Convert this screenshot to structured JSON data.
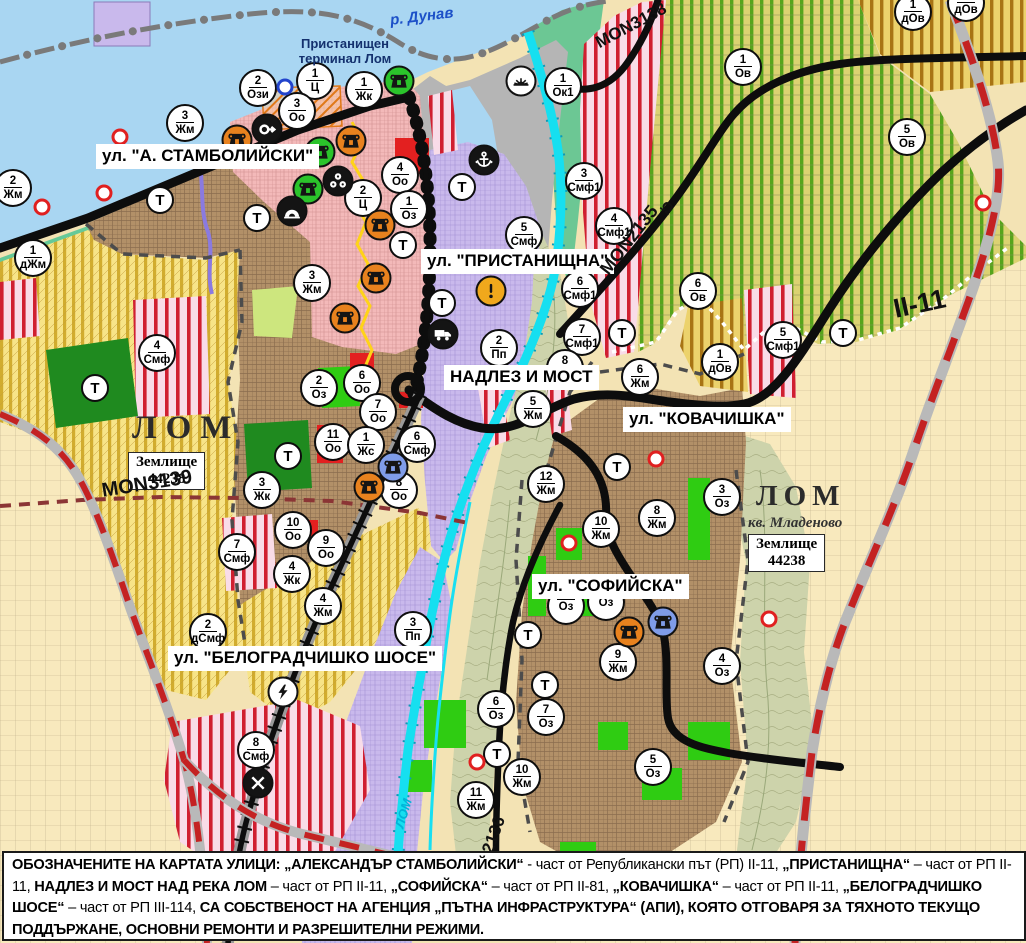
{
  "water": {
    "danube_label": "р. Дунав",
    "river_label": "ЛОМ"
  },
  "places": {
    "terminal_line1": "Пристанищен",
    "terminal_line2": "терминал Лом",
    "city1": "ЛОМ",
    "city2": "ЛОМ",
    "quarter": "кв. Младеново",
    "landplot_line1": "Землище",
    "landplot_line2": "44238"
  },
  "street_labels": [
    {
      "text": "ул. \"А. СТАМБОЛИЙСКИ\"",
      "x": 96,
      "y": 144
    },
    {
      "text": "ул. \"ПРИСТАНИЩНА\"",
      "x": 421,
      "y": 249
    },
    {
      "text": "НАДЛЕЗ И МОСТ",
      "x": 444,
      "y": 365
    },
    {
      "text": "ул. \"КОВАЧИШКА\"",
      "x": 623,
      "y": 407
    },
    {
      "text": "ул. \"СОФИЙСКА\"",
      "x": 532,
      "y": 574
    },
    {
      "text": "ул. \"БЕЛОГРАДЧИШКО ШОСЕ\"",
      "x": 168,
      "y": 646
    }
  ],
  "road_labels": [
    {
      "text": "MON3139",
      "x": 102,
      "y": 480,
      "rot": -9,
      "size": 20
    },
    {
      "text": "MON3138",
      "x": 597,
      "y": 34,
      "rot": -28,
      "size": 17
    },
    {
      "text": "MON2135",
      "x": 604,
      "y": 262,
      "rot": -52,
      "size": 18
    },
    {
      "text": "Ω",
      "x": 662,
      "y": 196,
      "rot": 38,
      "size": 15
    },
    {
      "text": "II-11",
      "x": 894,
      "y": 294,
      "rot": -12,
      "size": 27
    },
    {
      "text": "MON2136",
      "x": 474,
      "y": 880,
      "rot": -70,
      "size": 17
    }
  ],
  "zone_markers": [
    {
      "x": 13,
      "y": 188,
      "n": "2",
      "z": "Жм"
    },
    {
      "x": 185,
      "y": 123,
      "n": "3",
      "z": "Жм"
    },
    {
      "x": 258,
      "y": 88,
      "n": "2",
      "z": "Ози"
    },
    {
      "x": 315,
      "y": 81,
      "n": "1",
      "z": "Ц"
    },
    {
      "x": 297,
      "y": 111,
      "n": "3",
      "z": "Оо"
    },
    {
      "x": 364,
      "y": 90,
      "n": "1",
      "z": "Жк"
    },
    {
      "x": 400,
      "y": 175,
      "n": "4",
      "z": "Оо"
    },
    {
      "x": 363,
      "y": 198,
      "n": "2",
      "z": "Ц"
    },
    {
      "x": 409,
      "y": 209,
      "n": "1",
      "z": "Оз"
    },
    {
      "x": 563,
      "y": 86,
      "n": "1",
      "z": "Ок1"
    },
    {
      "x": 584,
      "y": 181,
      "n": "3",
      "z": "Смф1"
    },
    {
      "x": 524,
      "y": 235,
      "n": "5",
      "z": "Смф"
    },
    {
      "x": 614,
      "y": 226,
      "n": "4",
      "z": "Смф1"
    },
    {
      "x": 580,
      "y": 289,
      "n": "6",
      "z": "Смф1"
    },
    {
      "x": 582,
      "y": 337,
      "n": "7",
      "z": "Смф1"
    },
    {
      "x": 565,
      "y": 368,
      "n": "8",
      "z": "Жм"
    },
    {
      "x": 499,
      "y": 348,
      "n": "2",
      "z": "Пп"
    },
    {
      "x": 533,
      "y": 409,
      "n": "5",
      "z": "Жм"
    },
    {
      "x": 546,
      "y": 484,
      "n": "12",
      "z": "Жм"
    },
    {
      "x": 640,
      "y": 377,
      "n": "6",
      "z": "Жм"
    },
    {
      "x": 698,
      "y": 291,
      "n": "6",
      "z": "Ов"
    },
    {
      "x": 720,
      "y": 362,
      "n": "1",
      "z": "дОв"
    },
    {
      "x": 783,
      "y": 340,
      "n": "5",
      "z": "Смф1"
    },
    {
      "x": 743,
      "y": 67,
      "n": "1",
      "z": "Ов"
    },
    {
      "x": 907,
      "y": 137,
      "n": "5",
      "z": "Ов"
    },
    {
      "x": 913,
      "y": 12,
      "n": "1",
      "z": "дОв"
    },
    {
      "x": 966,
      "y": 3,
      "n": "1",
      "z": "дОв"
    },
    {
      "x": 33,
      "y": 258,
      "n": "1",
      "z": "дЖм"
    },
    {
      "x": 157,
      "y": 353,
      "n": "4",
      "z": "Смф"
    },
    {
      "x": 312,
      "y": 283,
      "n": "3",
      "z": "Жм"
    },
    {
      "x": 319,
      "y": 388,
      "n": "2",
      "z": "Оз"
    },
    {
      "x": 362,
      "y": 383,
      "n": "6",
      "z": "Оо"
    },
    {
      "x": 378,
      "y": 412,
      "n": "7",
      "z": "Оо"
    },
    {
      "x": 333,
      "y": 442,
      "n": "11",
      "z": "Оо"
    },
    {
      "x": 366,
      "y": 445,
      "n": "1",
      "z": "Жс"
    },
    {
      "x": 417,
      "y": 444,
      "n": "6",
      "z": "Смф"
    },
    {
      "x": 399,
      "y": 490,
      "n": "8",
      "z": "Оо"
    },
    {
      "x": 262,
      "y": 490,
      "n": "3",
      "z": "Жк"
    },
    {
      "x": 293,
      "y": 530,
      "n": "10",
      "z": "Оо"
    },
    {
      "x": 326,
      "y": 548,
      "n": "9",
      "z": "Оо"
    },
    {
      "x": 292,
      "y": 574,
      "n": "4",
      "z": "Жк"
    },
    {
      "x": 323,
      "y": 606,
      "n": "4",
      "z": "Жм"
    },
    {
      "x": 237,
      "y": 552,
      "n": "7",
      "z": "Смф"
    },
    {
      "x": 208,
      "y": 632,
      "n": "2",
      "z": "дСмф"
    },
    {
      "x": 413,
      "y": 630,
      "n": "3",
      "z": "Пп"
    },
    {
      "x": 256,
      "y": 750,
      "n": "8",
      "z": "Смф"
    },
    {
      "x": 601,
      "y": 529,
      "n": "10",
      "z": "Жм"
    },
    {
      "x": 657,
      "y": 518,
      "n": "8",
      "z": "Жм"
    },
    {
      "x": 566,
      "y": 606,
      "n": "",
      "z": "Оз"
    },
    {
      "x": 606,
      "y": 602,
      "n": "",
      "z": "Оз"
    },
    {
      "x": 618,
      "y": 662,
      "n": "9",
      "z": "Жм"
    },
    {
      "x": 722,
      "y": 666,
      "n": "4",
      "z": "Оз"
    },
    {
      "x": 496,
      "y": 709,
      "n": "6",
      "z": "Оз"
    },
    {
      "x": 546,
      "y": 717,
      "n": "7",
      "z": "Оз"
    },
    {
      "x": 653,
      "y": 767,
      "n": "5",
      "z": "Оз"
    },
    {
      "x": 522,
      "y": 777,
      "n": "10",
      "z": "Жм"
    },
    {
      "x": 476,
      "y": 800,
      "n": "11",
      "z": "Жм"
    },
    {
      "x": 722,
      "y": 497,
      "n": "3",
      "z": "Оз"
    }
  ],
  "t_markers": [
    {
      "x": 160,
      "y": 200
    },
    {
      "x": 257,
      "y": 218
    },
    {
      "x": 403,
      "y": 245
    },
    {
      "x": 442,
      "y": 303
    },
    {
      "x": 462,
      "y": 187
    },
    {
      "x": 95,
      "y": 388
    },
    {
      "x": 288,
      "y": 456
    },
    {
      "x": 622,
      "y": 333
    },
    {
      "x": 843,
      "y": 333
    },
    {
      "x": 617,
      "y": 467
    },
    {
      "x": 528,
      "y": 635
    },
    {
      "x": 545,
      "y": 685
    },
    {
      "x": 497,
      "y": 754
    }
  ],
  "t_label": "Т",
  "icon_markers": [
    {
      "x": 237,
      "y": 140,
      "icon": "monument-capital-icon",
      "bg": "#e8821e"
    },
    {
      "x": 267,
      "y": 129,
      "icon": "key-route-icon",
      "bg": "#141414"
    },
    {
      "x": 320,
      "y": 152,
      "icon": "monument-capital-icon",
      "bg": "#2bc42b"
    },
    {
      "x": 351,
      "y": 141,
      "icon": "monument-capital-icon",
      "bg": "#e8821e"
    },
    {
      "x": 338,
      "y": 181,
      "icon": "trefoil-icon",
      "bg": "#141414"
    },
    {
      "x": 308,
      "y": 189,
      "icon": "monument-capital-icon",
      "bg": "#2bc42b"
    },
    {
      "x": 292,
      "y": 211,
      "icon": "cave-icon",
      "bg": "#141414"
    },
    {
      "x": 380,
      "y": 225,
      "icon": "monument-capital-icon",
      "bg": "#e8821e"
    },
    {
      "x": 376,
      "y": 278,
      "icon": "monument-capital-icon",
      "bg": "#e8821e"
    },
    {
      "x": 345,
      "y": 318,
      "icon": "monument-capital-icon",
      "bg": "#e8821e"
    },
    {
      "x": 399,
      "y": 81,
      "icon": "monument-capital-icon",
      "bg": "#2bc42b"
    },
    {
      "x": 484,
      "y": 160,
      "icon": "anchor-icon",
      "bg": "#141414"
    },
    {
      "x": 521,
      "y": 81,
      "icon": "sun-resort-icon",
      "bg": "#ffffff"
    },
    {
      "x": 491,
      "y": 291,
      "icon": "warning-icon",
      "bg": "#f0a81c"
    },
    {
      "x": 443,
      "y": 334,
      "icon": "truck-icon",
      "bg": "#141414"
    },
    {
      "x": 393,
      "y": 467,
      "icon": "monument-capital-icon",
      "bg": "#7f9ce8"
    },
    {
      "x": 369,
      "y": 487,
      "icon": "monument-capital-icon",
      "bg": "#e8821e"
    },
    {
      "x": 663,
      "y": 622,
      "icon": "monument-capital-icon",
      "bg": "#7f9ce8"
    },
    {
      "x": 629,
      "y": 632,
      "icon": "monument-capital-icon",
      "bg": "#e8821e"
    },
    {
      "x": 283,
      "y": 692,
      "icon": "lightning-icon",
      "bg": "#ffffff"
    },
    {
      "x": 258,
      "y": 783,
      "icon": "rail-crossing-icon",
      "bg": "#141414"
    }
  ],
  "dot_markers": [
    {
      "x": 120,
      "y": 137,
      "c": "#e02020"
    },
    {
      "x": 104,
      "y": 193,
      "c": "#e02020"
    },
    {
      "x": 42,
      "y": 207,
      "c": "#e02020"
    },
    {
      "x": 569,
      "y": 543,
      "c": "#e02020"
    },
    {
      "x": 656,
      "y": 459,
      "c": "#e02020"
    },
    {
      "x": 477,
      "y": 762,
      "c": "#e02020"
    },
    {
      "x": 769,
      "y": 619,
      "c": "#e02020"
    },
    {
      "x": 983,
      "y": 203,
      "c": "#e02020"
    },
    {
      "x": 285,
      "y": 87,
      "c": "#2244cc"
    }
  ],
  "footnote": {
    "segments": [
      {
        "b": 1,
        "t": "ОБОЗНАЧЕНИТЕ НА КАРТАТА УЛИЦИ: „АЛЕКСАНДЪР СТАМБОЛИЙСКИ“"
      },
      {
        "b": 0,
        "t": " - част от Републикански път (РП) II-11, "
      },
      {
        "b": 1,
        "t": "„ПРИСТАНИЩНА“"
      },
      {
        "b": 0,
        "t": " – част от РП II-11, "
      },
      {
        "b": 1,
        "t": "НАДЛЕЗ И МОСТ НАД РЕКА ЛОМ"
      },
      {
        "b": 0,
        "t": " – част от РП II-11, "
      },
      {
        "b": 1,
        "t": "„СОФИЙСКА“"
      },
      {
        "b": 0,
        "t": " – част от РП II-81, "
      },
      {
        "b": 1,
        "t": "„КОВАЧИШКА“"
      },
      {
        "b": 0,
        "t": " – част от РП II-11, "
      },
      {
        "b": 1,
        "t": "„БЕЛОГРАДЧИШКО ШОСЕ“"
      },
      {
        "b": 0,
        "t": " – част от РП III-114, "
      },
      {
        "b": 1,
        "t": "СА СОБСТВЕНОСТ НА АГЕНЦИЯ „ПЪТНА ИНФРАСТРУКТУРА“ (АПИ), КОЯТО ОТГОВАРЯ ЗА ТЯХНОТО ТЕКУЩО ПОДДЪРЖАНЕ, ОСНОВНИ РЕМОНТИ И РАЗРЕШИТЕЛНИ РЕЖИМИ."
      }
    ]
  }
}
